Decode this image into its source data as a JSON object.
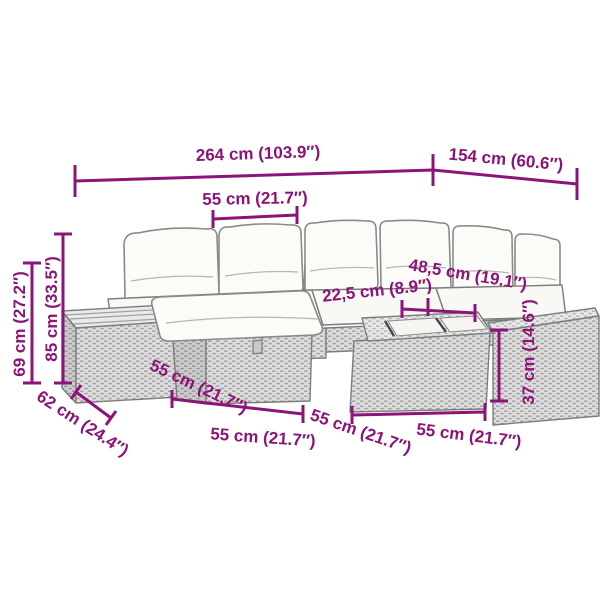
{
  "diagram": {
    "kind": "furniture-dimension-diagram",
    "illustration": "garden-lounge-set-line-art",
    "accent_color": "#8C1478",
    "furniture_color": "#dcdcdc",
    "cushion_color": "#fbfbf8",
    "dims": {
      "total_width": "264 cm (103.9″)",
      "total_depth": "154 cm (60.6″)",
      "seat_top": "55 cm (21.7″)",
      "back_height": "85 cm (33.5″)",
      "arm_height": "69 cm (27.2″)",
      "side_table_depth": "62 cm (24.4″)",
      "ottoman_front": "55 cm (21.7″)",
      "ottoman_width": "55 cm (21.7″)",
      "mid_width": "55 cm (21.7″)",
      "table_width": "55 cm (21.7″)",
      "slat_narrow": "22,5 cm (8.9″)",
      "slat_wide": "48,5 cm (19.1″)",
      "table_height": "37 cm (14.6″)"
    }
  }
}
